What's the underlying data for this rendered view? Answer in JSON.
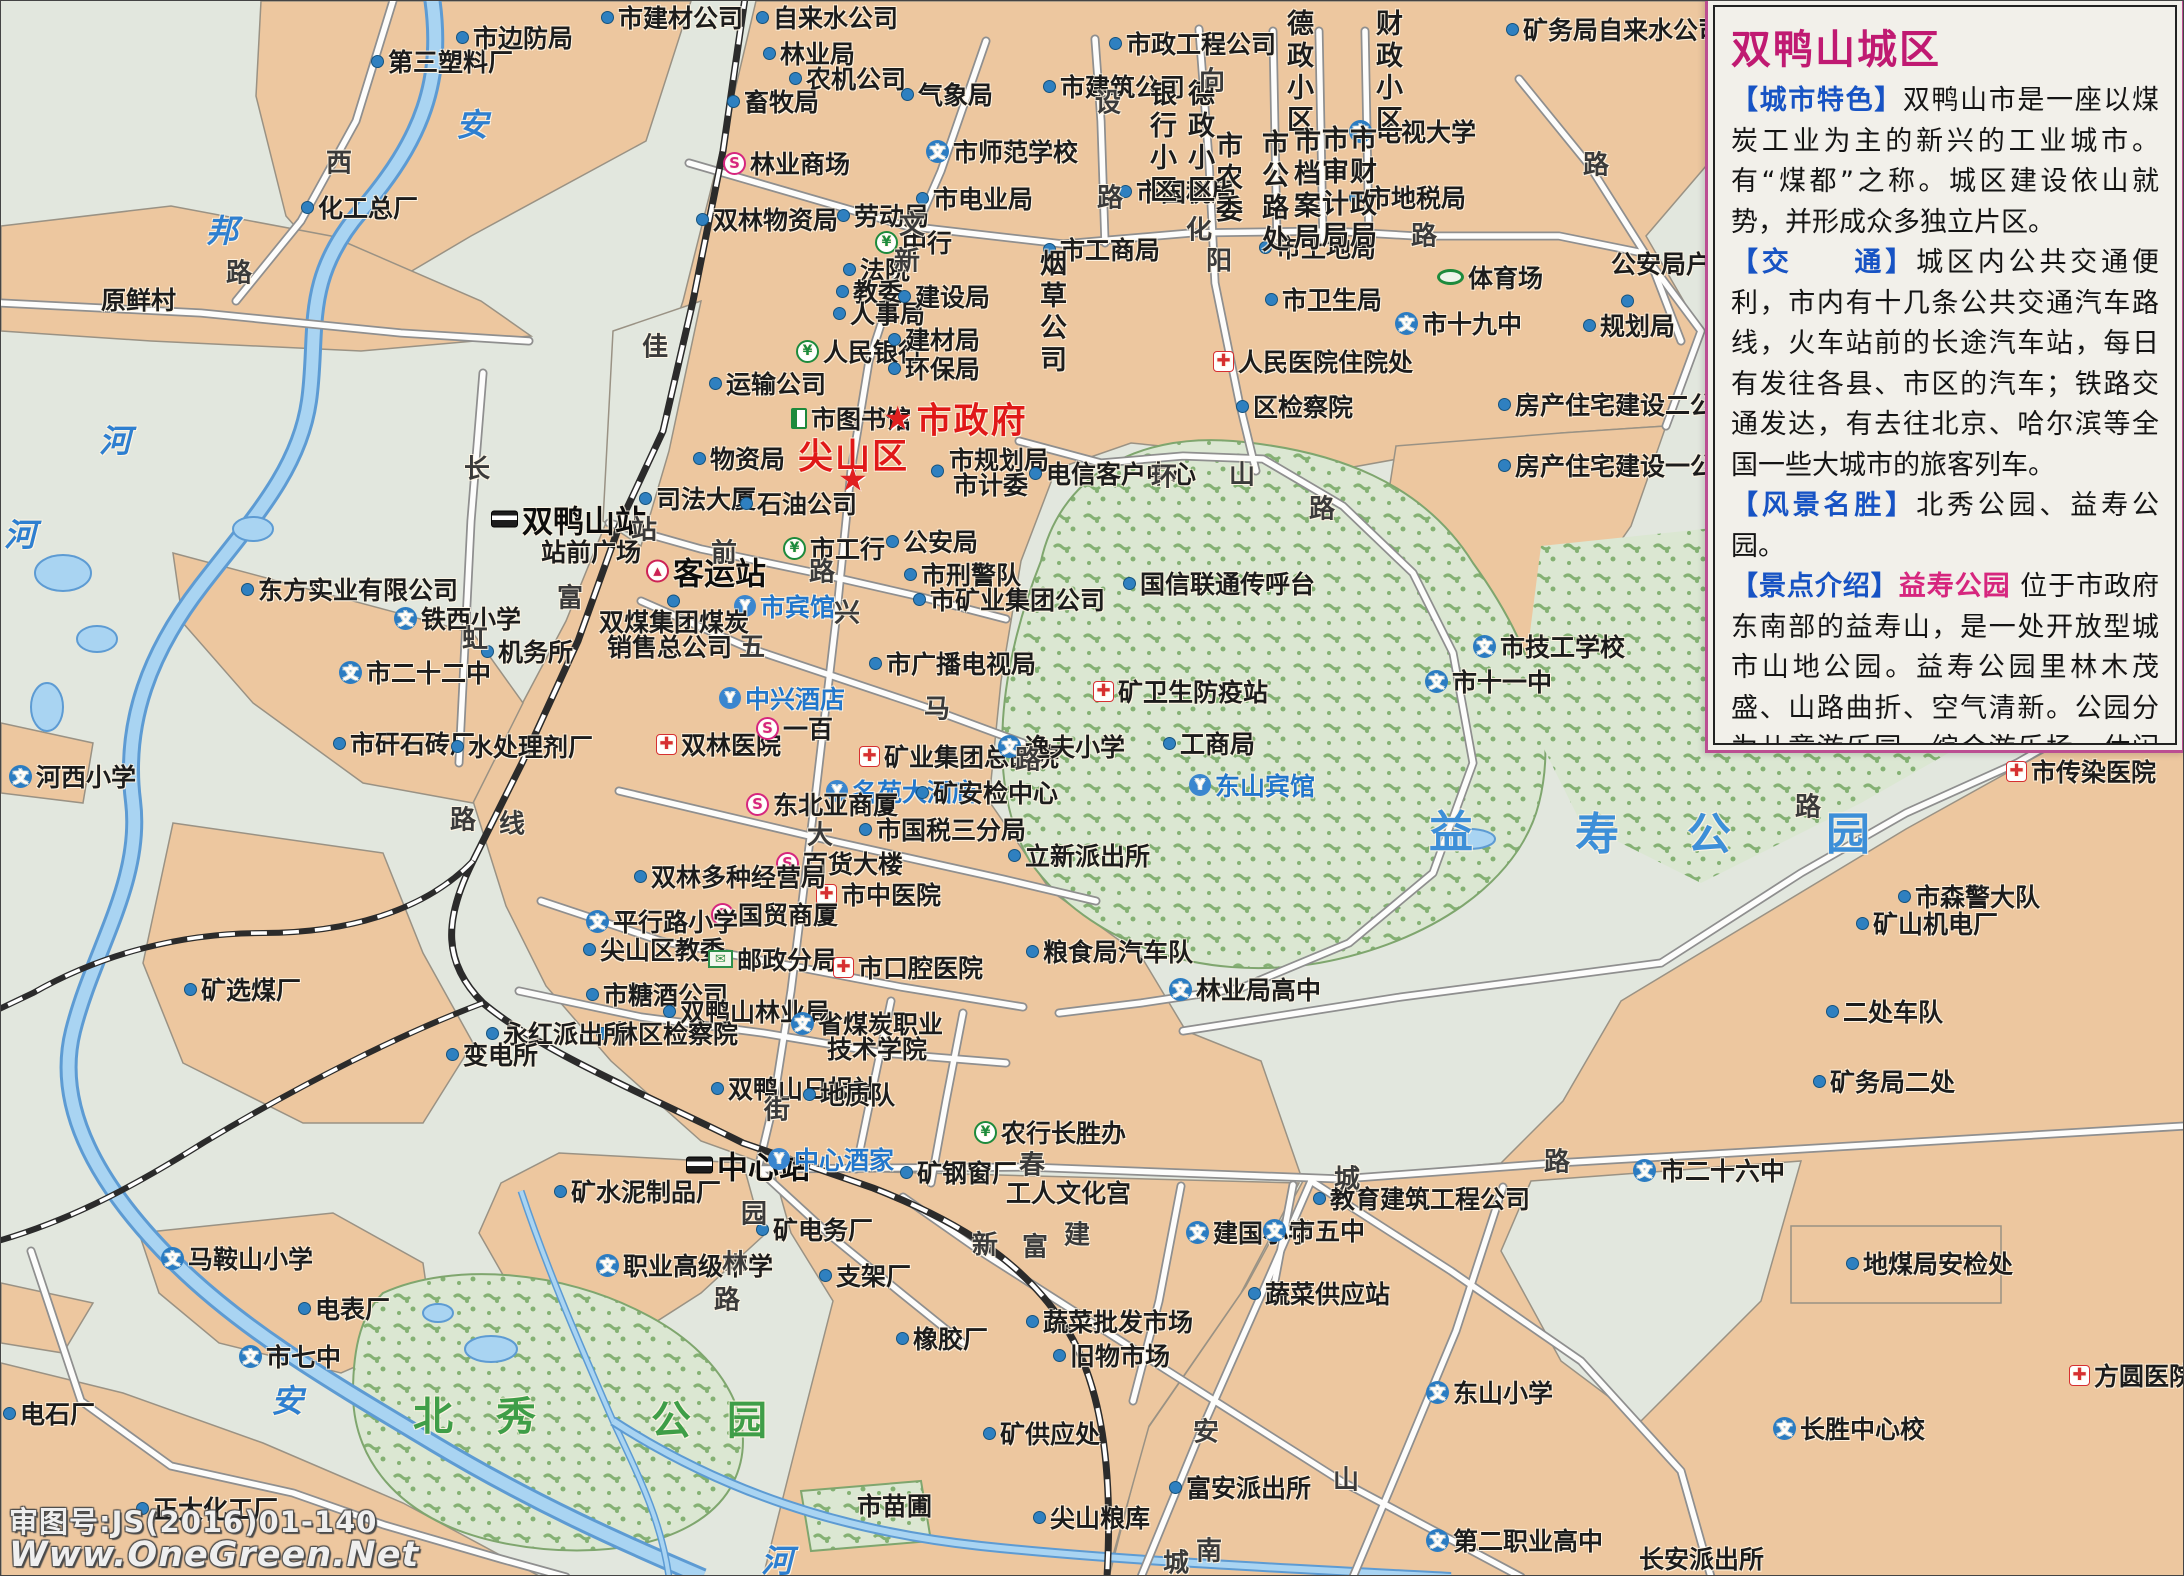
{
  "map_colors": {
    "background": "#e2e7de",
    "urban": "#edc79f",
    "park_base": "#dbe7d2",
    "park_dots": "#84b173",
    "water": "#a9d4f2",
    "water_edge": "#5d9bd3",
    "road": "#fdfdfc",
    "road_casing": "#8f8f8f",
    "railway": "#2b2b2b",
    "accent_red": "#e01818",
    "accent_blue": "#2277cc",
    "accent_magenta": "#d6267e",
    "accent_green": "#1d8a3c"
  },
  "icons": {
    "d": "poi-dot",
    "w": "school-icon",
    "s": "shopping-icon",
    "y": "bank-icon",
    "c": "hospital-icon",
    "h": "hotel-icon",
    "bus": "bus-station-icon",
    "st": "railway-station-icon",
    "book": "library-icon",
    "mail": "post-office-icon",
    "stad": "stadium-icon",
    "star": "government-star-icon"
  },
  "panel": {
    "title": "双鸭山城区",
    "sections": [
      {
        "head": "【城市特色】",
        "body": "双鸭山市是一座以煤炭工业为主的新兴的工业城市。有“煤都”之称。城区建设依山就势，并形成众多独立片区。"
      },
      {
        "head": "【交　　通】",
        "body": "城区内公共交通便利，市内有十几条公共交通汽车路线，火车站前的长途汽车站，每日有发往各县、市区的汽车；铁路交通发达，有去往北京、哈尔滨等全国一些大城市的旅客列车。"
      },
      {
        "head": "【风景名胜】",
        "body": "北秀公园、益寿公园。"
      },
      {
        "head": "【景点介绍】",
        "highlight": "益寿公园",
        "body": "位于市政府东南部的益寿山，是一处开放型城市山地公园。益寿公园里林木茂盛、山路曲折、空气清新。公园分为儿童游乐园、综合游乐场、休闲散步区等几个区域。登上山梁举目四望，山城景色尽收眼底。是山城人晨练、休闲的好去处。"
      }
    ]
  },
  "watermark": {
    "line1": "审图号:JS(2016)01-140",
    "line2": "Www.OneGreen.Net"
  },
  "labels": [
    [
      370,
      60,
      "第三塑料厂",
      "d",
      "p"
    ],
    [
      455,
      36,
      "市边防局",
      "d",
      "p"
    ],
    [
      300,
      206,
      "化工总厂",
      "d",
      "p"
    ],
    [
      100,
      298,
      "原鲜村",
      "",
      "p"
    ],
    [
      600,
      16,
      "市建材公司",
      "d",
      "p"
    ],
    [
      755,
      16,
      "自来水公司",
      "d",
      "p"
    ],
    [
      762,
      52,
      "林业局",
      "d",
      "p"
    ],
    [
      788,
      77,
      "农机公司",
      "d",
      "p"
    ],
    [
      726,
      100,
      "畜牧局",
      "d",
      "p"
    ],
    [
      900,
      93,
      "气象局",
      "d",
      "p"
    ],
    [
      722,
      162,
      "林业商场",
      "s",
      "p"
    ],
    [
      925,
      150,
      "市师范学校",
      "w",
      "p"
    ],
    [
      915,
      197,
      "市电业局",
      "d",
      "p"
    ],
    [
      695,
      218,
      "双林物资局",
      "d",
      "p"
    ],
    [
      836,
      214,
      "劳动局",
      "d",
      "p"
    ],
    [
      874,
      241,
      "中行",
      "y",
      "p"
    ],
    [
      1108,
      42,
      "市政工程公司",
      "d",
      "p"
    ],
    [
      1042,
      85,
      "市建筑公司",
      "d",
      "p"
    ],
    [
      1505,
      28,
      "矿务局自来水公司",
      "d",
      "p"
    ],
    [
      1348,
      130,
      "电视大学",
      "w",
      "p"
    ],
    [
      1118,
      190,
      "市国税局",
      "d",
      "p"
    ],
    [
      1348,
      196,
      "市地税局",
      "d",
      "p"
    ],
    [
      1042,
      248,
      "市工商局",
      "d",
      "p"
    ],
    [
      1258,
      246,
      "市土地局",
      "d",
      "p"
    ],
    [
      1264,
      298,
      "市卫生局",
      "d",
      "p"
    ],
    [
      1436,
      276,
      "体育场",
      "stad",
      "p"
    ],
    [
      1610,
      262,
      "公安局户政科",
      "",
      "p"
    ],
    [
      1620,
      300,
      "",
      "d",
      "p"
    ],
    [
      1394,
      322,
      "市十九中",
      "w",
      "p"
    ],
    [
      1582,
      324,
      "规划局",
      "d",
      "p"
    ],
    [
      1212,
      360,
      "人民医院住院处",
      "c",
      "p"
    ],
    [
      1235,
      405,
      "区检察院",
      "d",
      "p"
    ],
    [
      1497,
      403,
      "房产住宅建设二公司",
      "d",
      "p"
    ],
    [
      1497,
      464,
      "房产住宅建设一公司",
      "d",
      "p"
    ],
    [
      1140,
      78,
      "银行小区",
      "",
      "dv"
    ],
    [
      1178,
      78,
      "德政小区",
      "",
      "dv"
    ],
    [
      1277,
      8,
      "德政小区",
      "",
      "dv"
    ],
    [
      1366,
      8,
      "财政小区",
      "",
      "dv"
    ],
    [
      1030,
      248,
      "烟草公司",
      "",
      "pv"
    ],
    [
      1206,
      130,
      "市农委",
      "",
      "pv"
    ],
    [
      1252,
      128,
      "市公路处",
      "",
      "pv"
    ],
    [
      1284,
      126,
      "市档案局",
      "",
      "pv"
    ],
    [
      1312,
      124,
      "市审计局",
      "",
      "pv"
    ],
    [
      1340,
      124,
      "市财政局",
      "",
      "pv"
    ],
    [
      842,
      268,
      "法院",
      "d",
      "p"
    ],
    [
      835,
      290,
      "教委",
      "d",
      "p"
    ],
    [
      832,
      312,
      "人事局",
      "d",
      "p"
    ],
    [
      897,
      295,
      "建设局",
      "d",
      "p"
    ],
    [
      795,
      350,
      "人民银行",
      "y",
      "p"
    ],
    [
      887,
      338,
      "建材局",
      "d",
      "p"
    ],
    [
      887,
      367,
      "环保局",
      "d",
      "p"
    ],
    [
      708,
      382,
      "运输公司",
      "d",
      "p"
    ],
    [
      790,
      417,
      "市图书馆",
      "book",
      "p"
    ],
    [
      882,
      417,
      "市政府",
      "star",
      "r"
    ],
    [
      797,
      453,
      "尖山区",
      "",
      "r"
    ],
    [
      837,
      478,
      "",
      "star",
      "r"
    ],
    [
      692,
      457,
      "物资局",
      "d",
      "p"
    ],
    [
      948,
      458,
      "市规划局",
      "",
      "p"
    ],
    [
      952,
      483,
      "市计委",
      "",
      "p"
    ],
    [
      930,
      470,
      "",
      "d",
      "p"
    ],
    [
      1028,
      472,
      "电信客户中心",
      "d",
      "p"
    ],
    [
      885,
      540,
      "公安局",
      "d",
      "p"
    ],
    [
      903,
      573,
      "市刑警队",
      "d",
      "p"
    ],
    [
      912,
      598,
      "市矿业集团公司",
      "d",
      "p"
    ],
    [
      868,
      662,
      "市广播电视局",
      "d",
      "p"
    ],
    [
      1122,
      582,
      "国信联通传呼台",
      "d",
      "p"
    ],
    [
      490,
      518,
      "双鸭山站",
      "st",
      "big"
    ],
    [
      540,
      550,
      "站前广场",
      "",
      "p"
    ],
    [
      645,
      570,
      "客运站",
      "bus",
      "big"
    ],
    [
      733,
      605,
      "市宾馆",
      "h",
      "b"
    ],
    [
      598,
      620,
      "双煤集团煤炭",
      "",
      "p"
    ],
    [
      606,
      645,
      "销售总公司",
      "",
      "p"
    ],
    [
      666,
      600,
      "",
      "d",
      "p"
    ],
    [
      638,
      497,
      "司法大厦",
      "d",
      "p"
    ],
    [
      739,
      502,
      "石油公司",
      "d",
      "p"
    ],
    [
      782,
      547,
      "市工行",
      "y",
      "p"
    ],
    [
      240,
      588,
      "东方实业有限公司",
      "d",
      "p"
    ],
    [
      393,
      617,
      "铁西小学",
      "w",
      "p"
    ],
    [
      480,
      650,
      "机务所",
      "d",
      "p"
    ],
    [
      338,
      671,
      "市二十二中",
      "w",
      "p"
    ],
    [
      332,
      742,
      "市矸石砖厂",
      "d",
      "p"
    ],
    [
      450,
      745,
      "水处理剂厂",
      "d",
      "p"
    ],
    [
      655,
      743,
      "双林医院",
      "c",
      "p"
    ],
    [
      718,
      697,
      "中兴酒店",
      "h",
      "b"
    ],
    [
      755,
      727,
      "一百",
      "s",
      "p"
    ],
    [
      858,
      755,
      "矿业集团总医院",
      "c",
      "p"
    ],
    [
      825,
      790,
      "名苑大酒店",
      "h",
      "b"
    ],
    [
      745,
      803,
      "东北亚商厦",
      "s",
      "p"
    ],
    [
      858,
      828,
      "市国税三分局",
      "d",
      "p"
    ],
    [
      775,
      862,
      "百货大楼",
      "s",
      "p"
    ],
    [
      815,
      893,
      "市中医院",
      "c",
      "p"
    ],
    [
      633,
      875,
      "双林多种经营局",
      "d",
      "p"
    ],
    [
      710,
      913,
      "国贸商厦",
      "s",
      "p"
    ],
    [
      585,
      920,
      "平行路小学",
      "w",
      "p"
    ],
    [
      582,
      948,
      "尖山区教委",
      "d",
      "p"
    ],
    [
      707,
      958,
      "邮政分局",
      "mail",
      "p"
    ],
    [
      585,
      993,
      "市糖酒公司",
      "d",
      "p"
    ],
    [
      662,
      1010,
      "双鸭山林业局",
      "d",
      "p"
    ],
    [
      595,
      1032,
      "林区检察院",
      "d",
      "p"
    ],
    [
      485,
      1032,
      "永红派出所",
      "d",
      "p"
    ],
    [
      445,
      1053,
      "变电所",
      "d",
      "p"
    ],
    [
      710,
      1087,
      "双鸭山日报社",
      "d",
      "p"
    ],
    [
      802,
      1093,
      "地质队",
      "d",
      "p"
    ],
    [
      790,
      1022,
      "省煤炭职业",
      "w",
      "p"
    ],
    [
      826,
      1047,
      "技术学院",
      "",
      "p"
    ],
    [
      832,
      966,
      "市口腔医院",
      "c",
      "p"
    ],
    [
      1162,
      742,
      "工商局",
      "d",
      "p"
    ],
    [
      1092,
      690,
      "矿卫生防疫站",
      "c",
      "p"
    ],
    [
      997,
      745,
      "逸夫小学",
      "w",
      "p"
    ],
    [
      915,
      791,
      "矿安检中心",
      "d",
      "p"
    ],
    [
      1007,
      854,
      "立新派出所",
      "d",
      "p"
    ],
    [
      1188,
      784,
      "东山宾馆",
      "h",
      "b"
    ],
    [
      183,
      988,
      "矿选煤厂",
      "d",
      "p"
    ],
    [
      8,
      775,
      "河西小学",
      "w",
      "p"
    ],
    [
      1472,
      645,
      "市技工学校",
      "w",
      "p"
    ],
    [
      1424,
      680,
      "市十一中",
      "w",
      "p"
    ],
    [
      2005,
      770,
      "市传染医院",
      "c",
      "p"
    ],
    [
      1897,
      895,
      "市森警大队",
      "d",
      "p"
    ],
    [
      1855,
      922,
      "矿山机电厂",
      "d",
      "p"
    ],
    [
      1825,
      1010,
      "二处车队",
      "d",
      "p"
    ],
    [
      1812,
      1080,
      "矿务局二处",
      "d",
      "p"
    ],
    [
      1025,
      950,
      "粮食局汽车队",
      "d",
      "p"
    ],
    [
      1168,
      988,
      "林业局高中",
      "w",
      "p"
    ],
    [
      1845,
      1262,
      "地煤局安检处",
      "d",
      "p"
    ],
    [
      685,
      1164,
      "中心站",
      "st",
      "big"
    ],
    [
      767,
      1158,
      "中心酒家",
      "h",
      "b"
    ],
    [
      553,
      1190,
      "矿水泥制品厂",
      "d",
      "p"
    ],
    [
      755,
      1228,
      "矿电务厂",
      "d",
      "p"
    ],
    [
      595,
      1264,
      "职业高级中学",
      "w",
      "p"
    ],
    [
      818,
      1274,
      "支架厂",
      "d",
      "p"
    ],
    [
      895,
      1337,
      "橡胶厂",
      "d",
      "p"
    ],
    [
      899,
      1171,
      "矿钢窗厂",
      "d",
      "p"
    ],
    [
      1005,
      1191,
      "工人文化宫",
      "",
      "p"
    ],
    [
      973,
      1131,
      "农行长胜办",
      "y",
      "p"
    ],
    [
      1025,
      1320,
      "蔬菜批发市场",
      "d",
      "p"
    ],
    [
      1052,
      1354,
      "旧物市场",
      "d",
      "p"
    ],
    [
      1247,
      1292,
      "蔬菜供应站",
      "d",
      "p"
    ],
    [
      1185,
      1231,
      "建国小学",
      "w",
      "p"
    ],
    [
      1262,
      1229,
      "市五中",
      "w",
      "p"
    ],
    [
      1312,
      1197,
      "教育建筑工程公司",
      "d",
      "p"
    ],
    [
      1632,
      1169,
      "市二十六中",
      "w",
      "p"
    ],
    [
      1425,
      1391,
      "东山小学",
      "w",
      "p"
    ],
    [
      160,
      1257,
      "马鞍山小学",
      "w",
      "p"
    ],
    [
      297,
      1307,
      "电表厂",
      "d",
      "p"
    ],
    [
      238,
      1355,
      "市七中",
      "w",
      "p"
    ],
    [
      2,
      1412,
      "电石厂",
      "d",
      "p"
    ],
    [
      135,
      1507,
      "正大化工厂",
      "d",
      "p"
    ],
    [
      1032,
      1516,
      "尖山粮库",
      "d",
      "p"
    ],
    [
      982,
      1432,
      "矿供应处",
      "d",
      "p"
    ],
    [
      1168,
      1486,
      "富安派出所",
      "d",
      "p"
    ],
    [
      1425,
      1539,
      "第二职业高中",
      "w",
      "p"
    ],
    [
      1638,
      1557,
      "长安派出所",
      "",
      "p"
    ],
    [
      1772,
      1427,
      "长胜中心校",
      "w",
      "p"
    ],
    [
      2068,
      1374,
      "方圆医院",
      "c",
      "p"
    ],
    [
      856,
      1504,
      "市苗圃",
      "",
      "p"
    ],
    [
      898,
      222,
      "文",
      "",
      "rd"
    ],
    [
      893,
      258,
      "新",
      "",
      "rd"
    ],
    [
      833,
      610,
      "兴",
      "",
      "rd"
    ],
    [
      1185,
      227,
      "化",
      "",
      "rd"
    ],
    [
      1410,
      233,
      "路",
      "",
      "rd"
    ],
    [
      1094,
      100,
      "设",
      "",
      "rd"
    ],
    [
      1096,
      195,
      "路",
      "",
      "rd"
    ],
    [
      1198,
      78,
      "向",
      "",
      "rd"
    ],
    [
      1205,
      258,
      "阳",
      "",
      "rd"
    ],
    [
      1582,
      162,
      "路",
      "",
      "rd"
    ],
    [
      630,
      527,
      "站",
      "",
      "rd"
    ],
    [
      710,
      550,
      "前",
      "",
      "rd"
    ],
    [
      808,
      569,
      "路",
      "",
      "rd"
    ],
    [
      738,
      644,
      "五",
      "",
      "rd"
    ],
    [
      923,
      706,
      "马",
      "",
      "rd"
    ],
    [
      1014,
      757,
      "路",
      "",
      "rd"
    ],
    [
      806,
      832,
      "大",
      "",
      "rd"
    ],
    [
      763,
      1107,
      "街",
      "",
      "rd"
    ],
    [
      721,
      1261,
      "林",
      "",
      "rd"
    ],
    [
      713,
      1297,
      "路",
      "",
      "rd"
    ],
    [
      740,
      1211,
      "园",
      "",
      "rd"
    ],
    [
      1018,
      1162,
      "春",
      "",
      "rd"
    ],
    [
      971,
      1242,
      "新",
      "",
      "rd"
    ],
    [
      1021,
      1244,
      "富",
      "",
      "rd"
    ],
    [
      1063,
      1232,
      "建",
      "",
      "rd"
    ],
    [
      1333,
      1176,
      "城",
      "",
      "rd"
    ],
    [
      1543,
      1159,
      "路",
      "",
      "rd"
    ],
    [
      1192,
      1429,
      "安",
      "",
      "rd"
    ],
    [
      1332,
      1477,
      "山",
      "",
      "rd"
    ],
    [
      1195,
      1548,
      "南",
      "",
      "rd"
    ],
    [
      1162,
      1560,
      "城",
      "",
      "rd"
    ],
    [
      1794,
      804,
      "路",
      "",
      "rd"
    ],
    [
      641,
      344,
      "佳",
      "",
      "rd"
    ],
    [
      556,
      595,
      "富",
      "",
      "rd"
    ],
    [
      463,
      466,
      "长",
      "",
      "rd"
    ],
    [
      461,
      636,
      "虹",
      "",
      "rd"
    ],
    [
      449,
      817,
      "路",
      "",
      "rd"
    ],
    [
      498,
      821,
      "线",
      "",
      "rd"
    ],
    [
      325,
      160,
      "西",
      "",
      "rd"
    ],
    [
      225,
      270,
      "路",
      "",
      "rd"
    ],
    [
      1150,
      474,
      "环",
      "",
      "rd"
    ],
    [
      1228,
      472,
      "山",
      "",
      "rd"
    ],
    [
      1308,
      506,
      "路",
      "",
      "rd"
    ],
    [
      455,
      122,
      "安",
      "",
      "rv"
    ],
    [
      205,
      228,
      "邦",
      "",
      "rv"
    ],
    [
      98,
      438,
      "河",
      "",
      "rv"
    ],
    [
      3,
      532,
      "河",
      "",
      "rv"
    ],
    [
      270,
      1398,
      "安",
      "",
      "rv"
    ],
    [
      760,
      1558,
      "河",
      "",
      "rv"
    ],
    [
      412,
      1412,
      "北",
      "",
      "pg"
    ],
    [
      495,
      1412,
      "秀",
      "",
      "pg"
    ],
    [
      650,
      1416,
      "公",
      "",
      "pg"
    ],
    [
      726,
      1416,
      "园",
      "",
      "pg"
    ],
    [
      1428,
      827,
      "益",
      "",
      "pb"
    ],
    [
      1574,
      829,
      "寿",
      "",
      "pb"
    ],
    [
      1686,
      829,
      "公",
      "",
      "pb"
    ],
    [
      1825,
      829,
      "园",
      "",
      "pb"
    ]
  ]
}
